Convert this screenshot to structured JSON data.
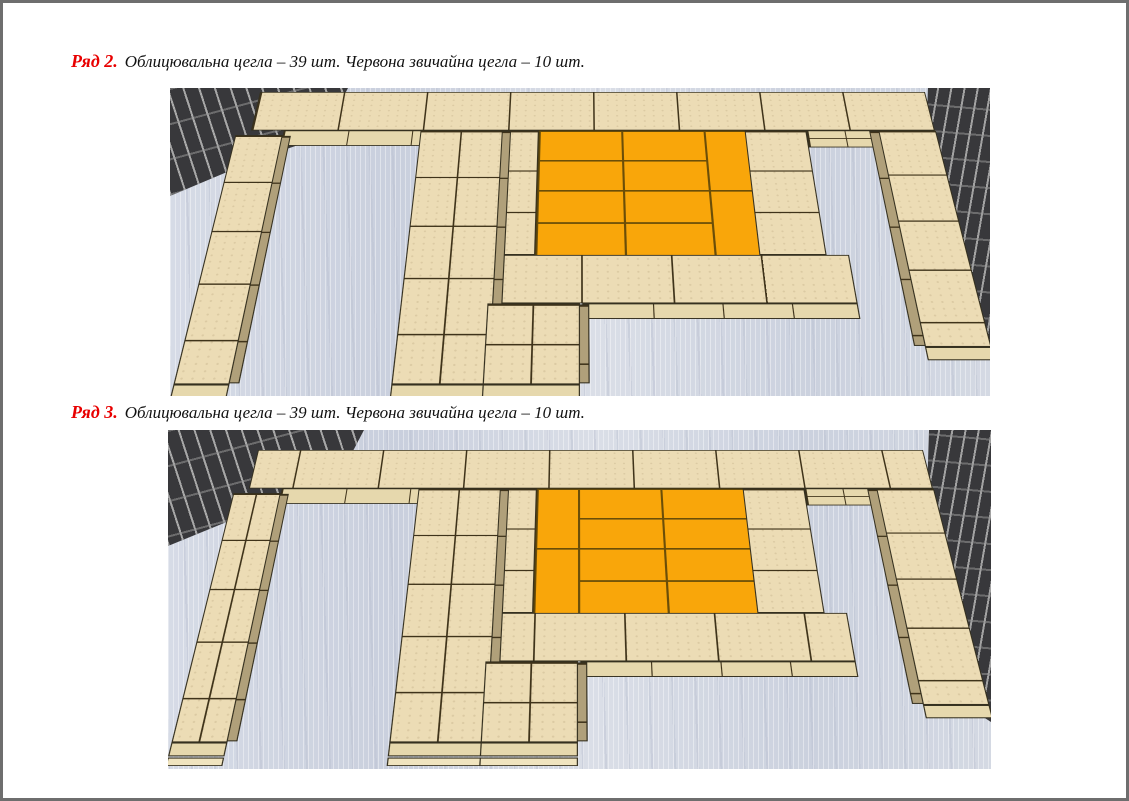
{
  "document": {
    "sections": [
      {
        "row_label": "Ряд 2.",
        "description": "Облицювальна цегла – 39 шт. Червона звичайна цегла – 10 шт.",
        "facing_brick_count": "39",
        "red_brick_count": "10",
        "red_bricks": [
          {
            "c": 1,
            "r": 1,
            "w": 2,
            "h": 1
          },
          {
            "c": 3,
            "r": 1,
            "w": 2,
            "h": 1
          },
          {
            "c": 5,
            "r": 1,
            "w": 1,
            "h": 2
          },
          {
            "c": 1,
            "r": 2,
            "w": 2,
            "h": 1
          },
          {
            "c": 3,
            "r": 2,
            "w": 2,
            "h": 1
          },
          {
            "c": 1,
            "r": 3,
            "w": 2,
            "h": 1
          },
          {
            "c": 3,
            "r": 3,
            "w": 2,
            "h": 1
          },
          {
            "c": 5,
            "r": 3,
            "w": 1,
            "h": 2
          },
          {
            "c": 1,
            "r": 4,
            "w": 2,
            "h": 1
          },
          {
            "c": 3,
            "r": 4,
            "w": 2,
            "h": 1
          }
        ]
      },
      {
        "row_label": "Ряд 3.",
        "description": "Облицювальна цегла – 39 шт. Червона звичайна цегла – 10 шт.",
        "facing_brick_count": "39",
        "red_brick_count": "10",
        "red_bricks": [
          {
            "c": 1,
            "r": 1,
            "w": 1,
            "h": 2
          },
          {
            "c": 2,
            "r": 1,
            "w": 2,
            "h": 1
          },
          {
            "c": 4,
            "r": 1,
            "w": 2,
            "h": 1
          },
          {
            "c": 2,
            "r": 2,
            "w": 2,
            "h": 1
          },
          {
            "c": 4,
            "r": 2,
            "w": 2,
            "h": 1
          },
          {
            "c": 1,
            "r": 3,
            "w": 1,
            "h": 2
          },
          {
            "c": 2,
            "r": 3,
            "w": 2,
            "h": 1
          },
          {
            "c": 4,
            "r": 3,
            "w": 2,
            "h": 1
          },
          {
            "c": 2,
            "r": 4,
            "w": 2,
            "h": 1
          },
          {
            "c": 4,
            "r": 4,
            "w": 2,
            "h": 1
          }
        ]
      }
    ]
  },
  "colors": {
    "row_label_red": "#e80000",
    "text": "#111111",
    "page_border": "#6e6e6e",
    "facing_brick": "#ecdcb5",
    "facing_brick_side": "#b0a07a",
    "facing_brick_edge": "#e6d8ad",
    "red_brick": "#f9a60a",
    "brick_joint": "#3f331a",
    "wall_brick": "#38383b",
    "wall_mortar": "#a3a3a3",
    "floor": "#ced4e0"
  }
}
